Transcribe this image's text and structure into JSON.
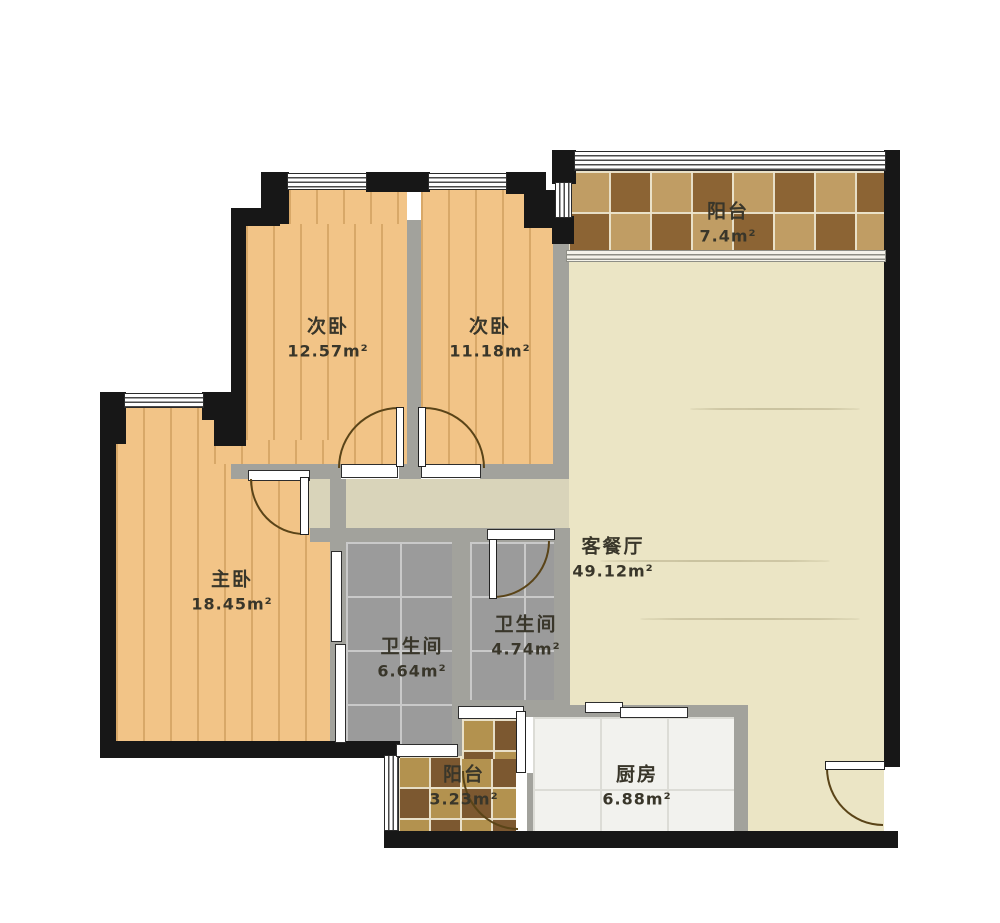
{
  "floorplan": {
    "type": "apartment-floor-plan",
    "rooms": [
      {
        "id": "balcony-top",
        "name": "阳台",
        "area": "7.4m²"
      },
      {
        "id": "bedroom-a",
        "name": "次卧",
        "area": "12.57m²"
      },
      {
        "id": "bedroom-b",
        "name": "次卧",
        "area": "11.18m²"
      },
      {
        "id": "master-bedroom",
        "name": "主卧",
        "area": "18.45m²"
      },
      {
        "id": "living-dining",
        "name": "客餐厅",
        "area": "49.12m²"
      },
      {
        "id": "bathroom-a",
        "name": "卫生间",
        "area": "6.64m²"
      },
      {
        "id": "bathroom-b",
        "name": "卫生间",
        "area": "4.74m²"
      },
      {
        "id": "balcony-bottom",
        "name": "阳台",
        "area": "3.23m²"
      },
      {
        "id": "kitchen",
        "name": "厨房",
        "area": "6.88m²"
      }
    ],
    "colors": {
      "wall": "#171717",
      "partition": "#a2a29c",
      "wood_floor": "#f2c487",
      "bath_tile": "#9b9b9b",
      "living_floor": "#ebe5c5",
      "kitchen_floor": "#f2f2ee",
      "balcony_tile_dark": "#8c6434",
      "balcony_tile_light": "#c09d64",
      "label_text": "#39362a"
    }
  }
}
